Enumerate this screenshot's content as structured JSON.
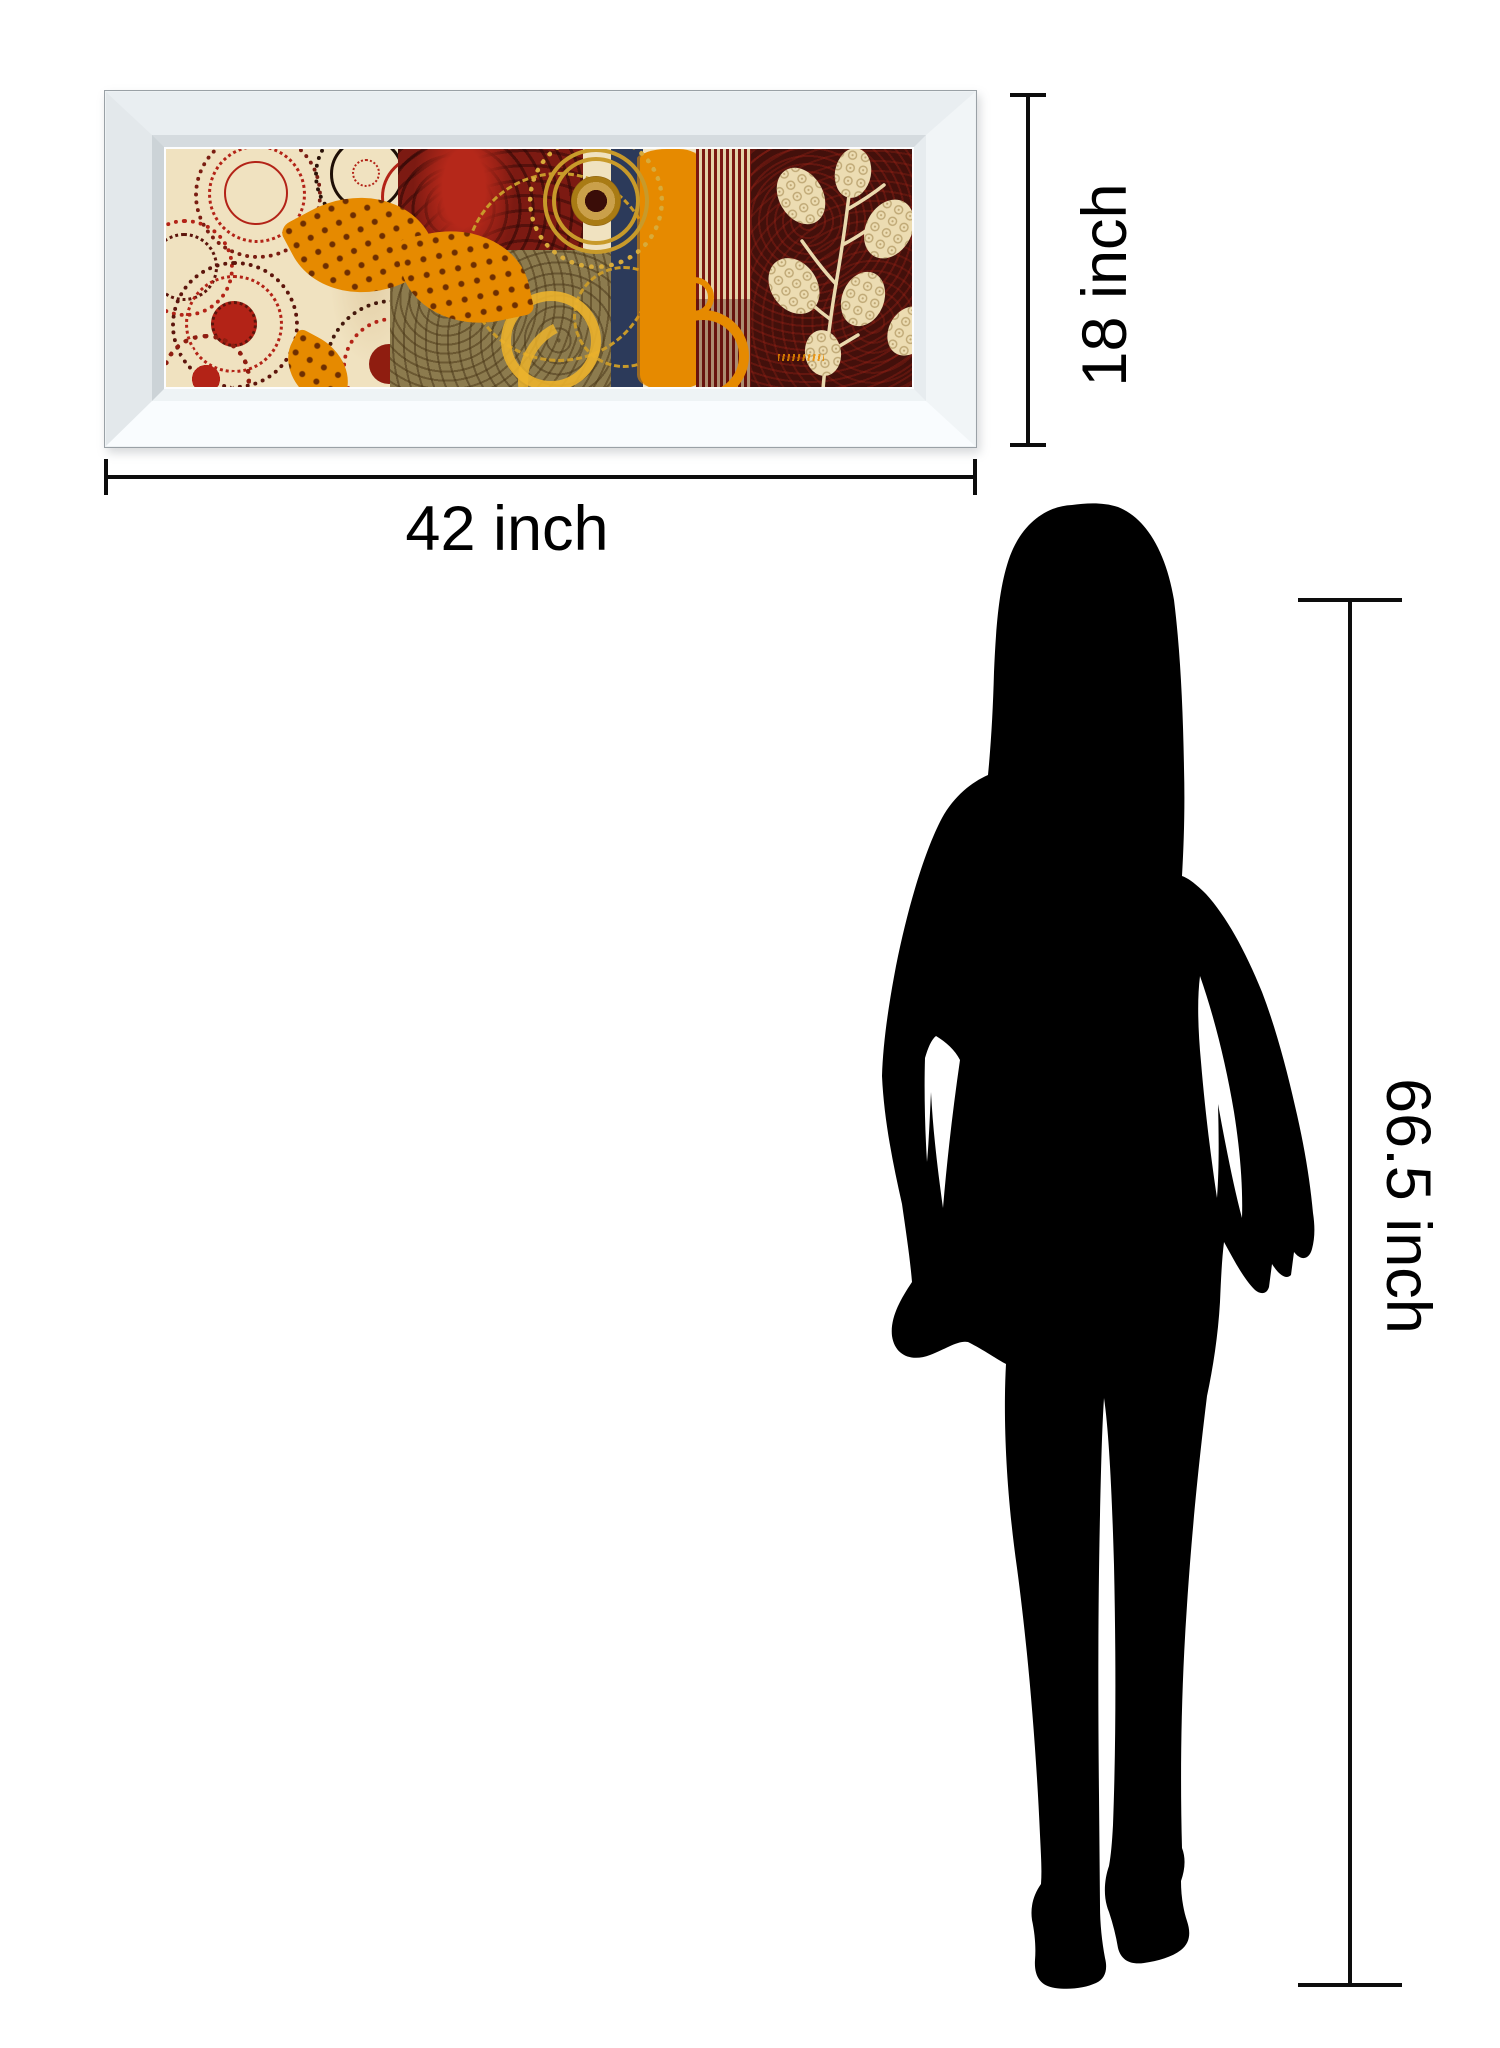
{
  "figure": {
    "artwork_width_label": "42 inch",
    "artwork_height_label": "18 inch",
    "person_height_label": "66.5 inch"
  },
  "colors": {
    "line": "#0d0d0d",
    "silhouette": "#000000",
    "frame_silver": "#e9eef1",
    "frame_silver_light": "#f9fcfe",
    "frame_silver_dark": "#ccd3d7",
    "art_cream": "#f0e2c0",
    "art_red": "#b32317",
    "art_red_dark": "#7c1a12",
    "art_maroon": "#43100b",
    "art_orange": "#e68a00",
    "art_navy": "#2c3a5a",
    "art_olive": "#8c7b4e",
    "art_gold": "#c89a2a",
    "art_yellow": "#ecb32c"
  }
}
